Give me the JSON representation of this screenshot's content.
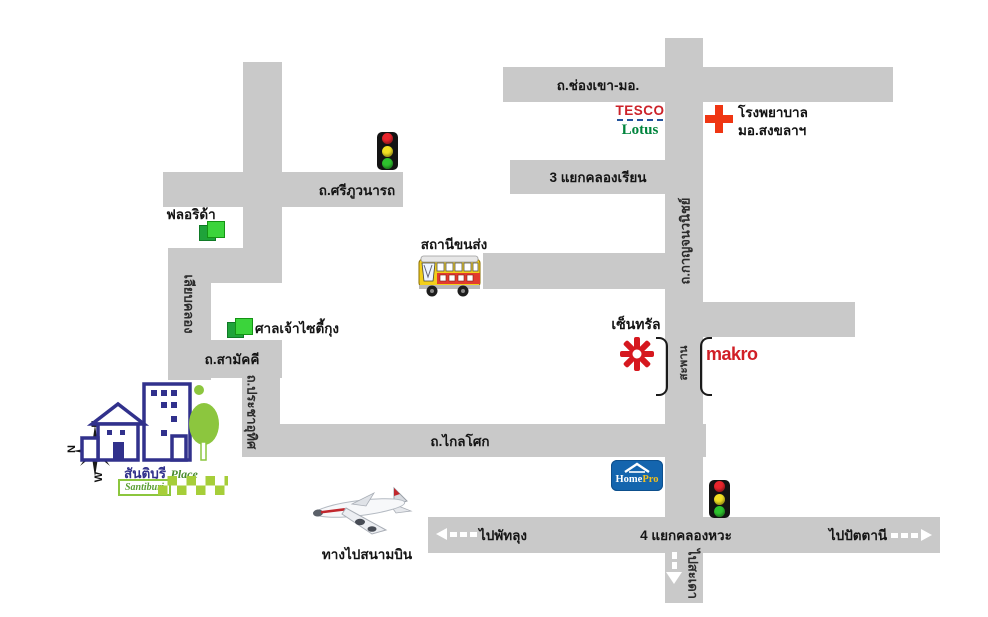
{
  "map": {
    "roads": {
      "chong_khao": "ถ.ช่องเขา-มอ.",
      "klong_rian": "3 แยกคลองเรียน",
      "sri_phuwanart": "ถ.ศรีภูวนารถ",
      "kanjanavanich": "ถ.กาญจนวนิชย์",
      "liab_klong": "เลียบคลอง",
      "samakkee": "ถ.สามัคคี",
      "pracha_uthit": "ถ.ประชาอุทิศ",
      "klai_sok": "ถ.ไกลโศก",
      "klong_wa": "4 แยกคลองหวะ",
      "saphan": "สะพาน"
    },
    "places": {
      "florida": "ฟลอริด้า",
      "shrine": "ศาลเจ้าไซตี้กุง",
      "bus_station": "สถานีขนส่ง",
      "central": "เซ็นทรัล",
      "makro": "makro",
      "hospital_line1": "โรงพยาบาล",
      "hospital_line2": "มอ.สงขลาฯ",
      "tesco_line1": "TESCO",
      "tesco_line2": "Lotus",
      "homepro_home": "Home",
      "homepro_pro": "Pro",
      "airport": "ทางไปสนามบิน"
    },
    "directions": {
      "phatthalung": "ไปพัทลุง",
      "pattani": "ไปปัตตานี",
      "sadao": "ไปสะเดา"
    },
    "brand": {
      "name_thai": "สันติบุรี",
      "name_place": "Place",
      "name_english": "Santiburi"
    },
    "compass": {
      "n": "N",
      "e": "E",
      "w": "W"
    },
    "icons": {
      "traffic_light": "traffic-light-icon",
      "hospital_cross": "hospital-cross-icon",
      "bus": "bus-icon",
      "airplane": "airplane-icon",
      "compass": "compass-icon",
      "central_star": "central-star-icon",
      "green_squares": "green-squares-icon",
      "bridge_brackets": "bridge-bracket-icon"
    },
    "colors": {
      "road_gray": "#c9c9c9",
      "tesco_red": "#cc2229",
      "lotus_green": "#00843d",
      "cross_red": "#ef3512",
      "central_red": "#d6181f",
      "makro_red": "#d11f26",
      "homepro_blue": "#1465ae",
      "homepro_yellow": "#f2c01e",
      "brand_navy": "#31318c",
      "brand_green": "#8cc63e"
    }
  }
}
